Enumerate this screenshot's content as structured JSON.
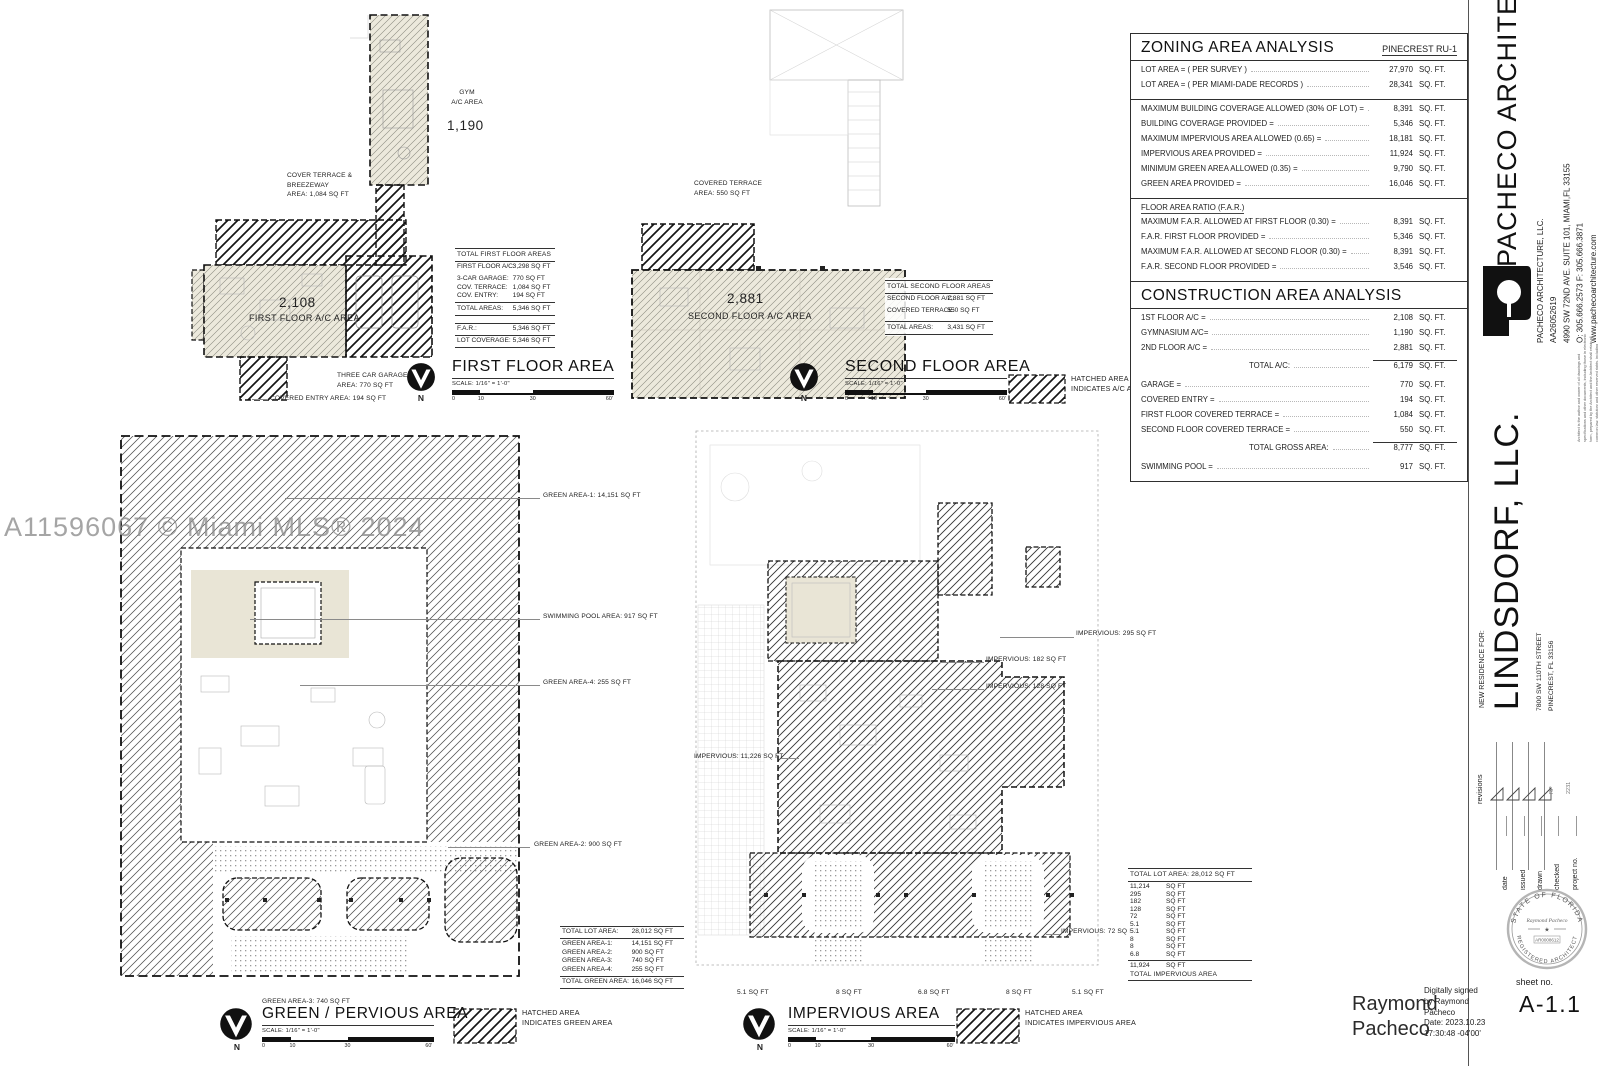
{
  "watermark": "A11596067 © Miami MLS® 2024",
  "north": "N",
  "scale_note": "SCALE: 1/16\" = 1'-0\"",
  "scale_ticks": {
    "t0": "0",
    "t10": "10",
    "t30": "30",
    "t60": "60'"
  },
  "legend_ac": {
    "l1": "HATCHED AREA",
    "l2": "INDICATES A/C AREA"
  },
  "legend_green": {
    "l1": "HATCHED AREA",
    "l2": "INDICATES GREEN AREA"
  },
  "legend_imp": {
    "l1": "HATCHED AREA",
    "l2": "INDICATES IMPERVIOUS AREA"
  },
  "first_floor": {
    "title": "FIRST FLOOR AREA",
    "gym_label": "GYM\nA/C AREA",
    "gym_value": "1,190",
    "terrace_label": "COVER TERRACE &\nBREEZEWAY\nAREA: 1,084 SQ FT",
    "ac_value": "2,108",
    "ac_label": "FIRST FLOOR A/C AREA",
    "garage_label": "THREE CAR GARAGE\nAREA: 770 SQ FT",
    "entry_label": "COVERED ENTRY AREA: 194 SQ FT",
    "table": {
      "header": "TOTAL FIRST FLOOR AREAS",
      "row_ac": {
        "l": "FIRST FLOOR A/C:",
        "v": "3,298 SQ FT"
      },
      "rows": [
        {
          "l": "3-CAR GARAGE:",
          "v": "770 SQ FT"
        },
        {
          "l": "COV. TERRACE:",
          "v": "1,084 SQ FT"
        },
        {
          "l": "COV. ENTRY:",
          "v": "194 SQ FT"
        }
      ],
      "total": {
        "l": "TOTAL AREAS:",
        "v": "5,346 SQ FT"
      },
      "rows2": [
        {
          "l": "F.A.R.:",
          "v": "5,346 SQ FT"
        },
        {
          "l": "LOT COVERAGE:",
          "v": "5,346 SQ FT"
        }
      ]
    }
  },
  "second_floor": {
    "title": "SECOND FLOOR AREA",
    "terrace_label": "COVERED TERRACE\nAREA: 550 SQ FT",
    "ac_value": "2,881",
    "ac_label": "SECOND FLOOR A/C AREA",
    "table": {
      "header": "TOTAL SECOND FLOOR AREAS",
      "row_ac": {
        "l": "SECOND FLOOR A/C:",
        "v": "2,881 SQ FT"
      },
      "rows": [
        {
          "l": "COVERED TERRACE:",
          "v": "550 SQ FT"
        }
      ],
      "total": {
        "l": "TOTAL AREAS:",
        "v": "3,431 SQ FT"
      }
    }
  },
  "zoning": {
    "title": "ZONING AREA ANALYSIS",
    "zone": "PINECREST  RU-1",
    "rows1": [
      {
        "l": "LOT AREA =    ( PER SURVEY )",
        "v": "27,970",
        "u": "SQ. FT."
      },
      {
        "l": "LOT AREA =    ( PER MIAMI-DADE RECORDS )",
        "v": "28,341",
        "u": "SQ. FT."
      }
    ],
    "rows2": [
      {
        "l": "MAXIMUM BUILDING COVERAGE ALLOWED (30% OF LOT) =",
        "v": "8,391",
        "u": "SQ. FT."
      },
      {
        "l": "BUILDING COVERAGE PROVIDED =",
        "v": "5,346",
        "u": "SQ. FT."
      },
      {
        "l": "MAXIMUM IMPERVIOUS AREA ALLOWED (0.65) =",
        "v": "18,181",
        "u": "SQ. FT."
      },
      {
        "l": "IMPERVIOUS AREA PROVIDED =",
        "v": "11,924",
        "u": "SQ. FT."
      },
      {
        "l": "MINIMUM GREEN AREA ALLOWED (0.35) =",
        "v": "9,790",
        "u": "SQ. FT."
      },
      {
        "l": "GREEN AREA PROVIDED =",
        "v": "16,046",
        "u": "SQ. FT."
      }
    ],
    "far_header": "FLOOR AREA RATIO (F.A.R.)",
    "rows3": [
      {
        "l": "MAXIMUM F.A.R. ALLOWED AT FIRST FLOOR (0.30) =",
        "v": "8,391",
        "u": "SQ. FT."
      },
      {
        "l": "F.A.R. FIRST FLOOR PROVIDED =",
        "v": "5,346",
        "u": "SQ. FT."
      },
      {
        "l": "MAXIMUM F.A.R. ALLOWED AT SECOND FLOOR (0.30) =",
        "v": "8,391",
        "u": "SQ. FT."
      },
      {
        "l": "F.A.R. SECOND FLOOR PROVIDED =",
        "v": "3,546",
        "u": "SQ. FT."
      }
    ]
  },
  "construction": {
    "title": "CONSTRUCTION AREA ANALYSIS",
    "rows1": [
      {
        "l": "1ST FLOOR  A/C =",
        "v": "2,108",
        "u": "SQ. FT."
      },
      {
        "l": "GYMNASIUM A/C=",
        "v": "1,190",
        "u": "SQ. FT."
      },
      {
        "l": "2ND FLOOR A/C =",
        "v": "2,881",
        "u": "SQ. FT."
      }
    ],
    "total_ac": {
      "l": "TOTAL A/C:",
      "v": "6,179",
      "u": "SQ. FT."
    },
    "rows2": [
      {
        "l": "GARAGE =",
        "v": "770",
        "u": "SQ. FT."
      },
      {
        "l": "COVERED ENTRY =",
        "v": "194",
        "u": "SQ. FT."
      },
      {
        "l": "FIRST FLOOR COVERED TERRACE =",
        "v": "1,084",
        "u": "SQ. FT."
      },
      {
        "l": "SECOND FLOOR COVERED TERRACE =",
        "v": "550",
        "u": "SQ. FT."
      }
    ],
    "total_gross": {
      "l": "TOTAL GROSS AREA:",
      "v": "8,777",
      "u": "SQ. FT."
    },
    "pool_row": {
      "l": "SWIMMING POOL =",
      "v": "917",
      "u": "SQ. FT."
    }
  },
  "green": {
    "title": "GREEN / PERVIOUS AREA",
    "labels": {
      "a1": "GREEN AREA-1: 14,151 SQ FT",
      "pool": "SWIMMING POOL AREA: 917 SQ FT",
      "a4": "GREEN  AREA-4: 255 SQ FT",
      "a2": "GREEN  AREA-2: 900 SQ FT",
      "a3": "GREEN  AREA-3: 740 SQ FT"
    },
    "table": {
      "header": {
        "l": "TOTAL LOT AREA:",
        "v": "28,012 SQ FT"
      },
      "rows": [
        {
          "l": "GREEN AREA-1:",
          "v": "14,151 SQ FT"
        },
        {
          "l": "GREEN AREA-2:",
          "v": "900 SQ FT"
        },
        {
          "l": "GREEN AREA-3:",
          "v": "740 SQ FT"
        },
        {
          "l": "GREEN AREA-4:",
          "v": "255 SQ FT"
        }
      ],
      "total": {
        "l": "TOTAL GREEN AREA:",
        "v": "16,046 SQ FT"
      }
    }
  },
  "impervious": {
    "title": "IMPERVIOUS AREA",
    "labels": {
      "i295": "IMPERVIOUS: 295 SQ FT",
      "i182": "IMPERVIOUS: 182 SQ FT",
      "i128": "IMPERVIOUS: 128 SQ FT",
      "i11226": "IMPERVIOUS: 11,226 SQ FT",
      "i72": "IMPERVIOUS: 72 SQ FT",
      "c1": "5.1 SQ FT",
      "c2": "8 SQ FT",
      "c3": "6.8 SQ FT",
      "c4": "8 SQ FT",
      "c5": "5.1 SQ FT"
    },
    "table": {
      "header": "TOTAL LOT AREA: 28,012 SQ FT",
      "rows": [
        {
          "v": "11,214",
          "u": "SQ FT"
        },
        {
          "v": "295",
          "u": "SQ FT"
        },
        {
          "v": "182",
          "u": "SQ FT"
        },
        {
          "v": "128",
          "u": "SQ FT"
        },
        {
          "v": "72",
          "u": "SQ FT"
        },
        {
          "v": "5.1",
          "u": "SQ FT"
        },
        {
          "v": "5.1",
          "u": "SQ FT"
        },
        {
          "v": "8",
          "u": "SQ FT"
        },
        {
          "v": "8",
          "u": "SQ FT"
        },
        {
          "v": "6.8",
          "u": "SQ FT"
        }
      ],
      "total_v": "11,924",
      "total_u": "SQ FT",
      "total_label": "TOTAL IMPERVIOUS AREA"
    }
  },
  "titleblock": {
    "firm": "PACHECO ARCHITECTURE",
    "contact": "PACHECO ARCHITECTURE, LLC.\nAA26052619\n4990 SW 72ND AVE. SUITE 101, MIAMI,FL 33155\nO: 305.666.2573   F: 305.666.3871\nwww.pachecoarchitecture.com",
    "logo_letter": "P",
    "disclaimer": "Architect is the author and owner of all drawings and specifications and other documents, including those in electronic form, prepared by the Architect and the Architect shall retain all common law, statutory and other reserved rights, including copyrights to the project. The owner shall not use the Architect's drawings and specifications on other projects.",
    "client_intro": "NEW RESIDENCE FOR:",
    "client": "LINDSDORF, LLC.",
    "project_address": "7800 SW 110TH STREET\nPINECREST, FL 33156",
    "revisions_label": "revisions",
    "field_date": "date",
    "field_issued": "issued",
    "field_drawn": "drawn",
    "field_checked": "checked",
    "field_project": "project no.",
    "value_drawn": "RP",
    "value_project": "2231",
    "seal_top": "STATE OF FLORIDA",
    "seal_bottom": "REGISTERED ARCHITECT",
    "seal_name": "Raymond Pacheco",
    "seal_no": "AR0008612",
    "sheet_label": "sheet no.",
    "sheet_no": "A-1.1"
  },
  "signature": {
    "name_l1": "Raymond",
    "name_l2": "Pacheco",
    "details": "Digitally signed\nby Raymond\nPacheco\nDate: 2023.10.23\n17:30:48 -04'00'"
  }
}
